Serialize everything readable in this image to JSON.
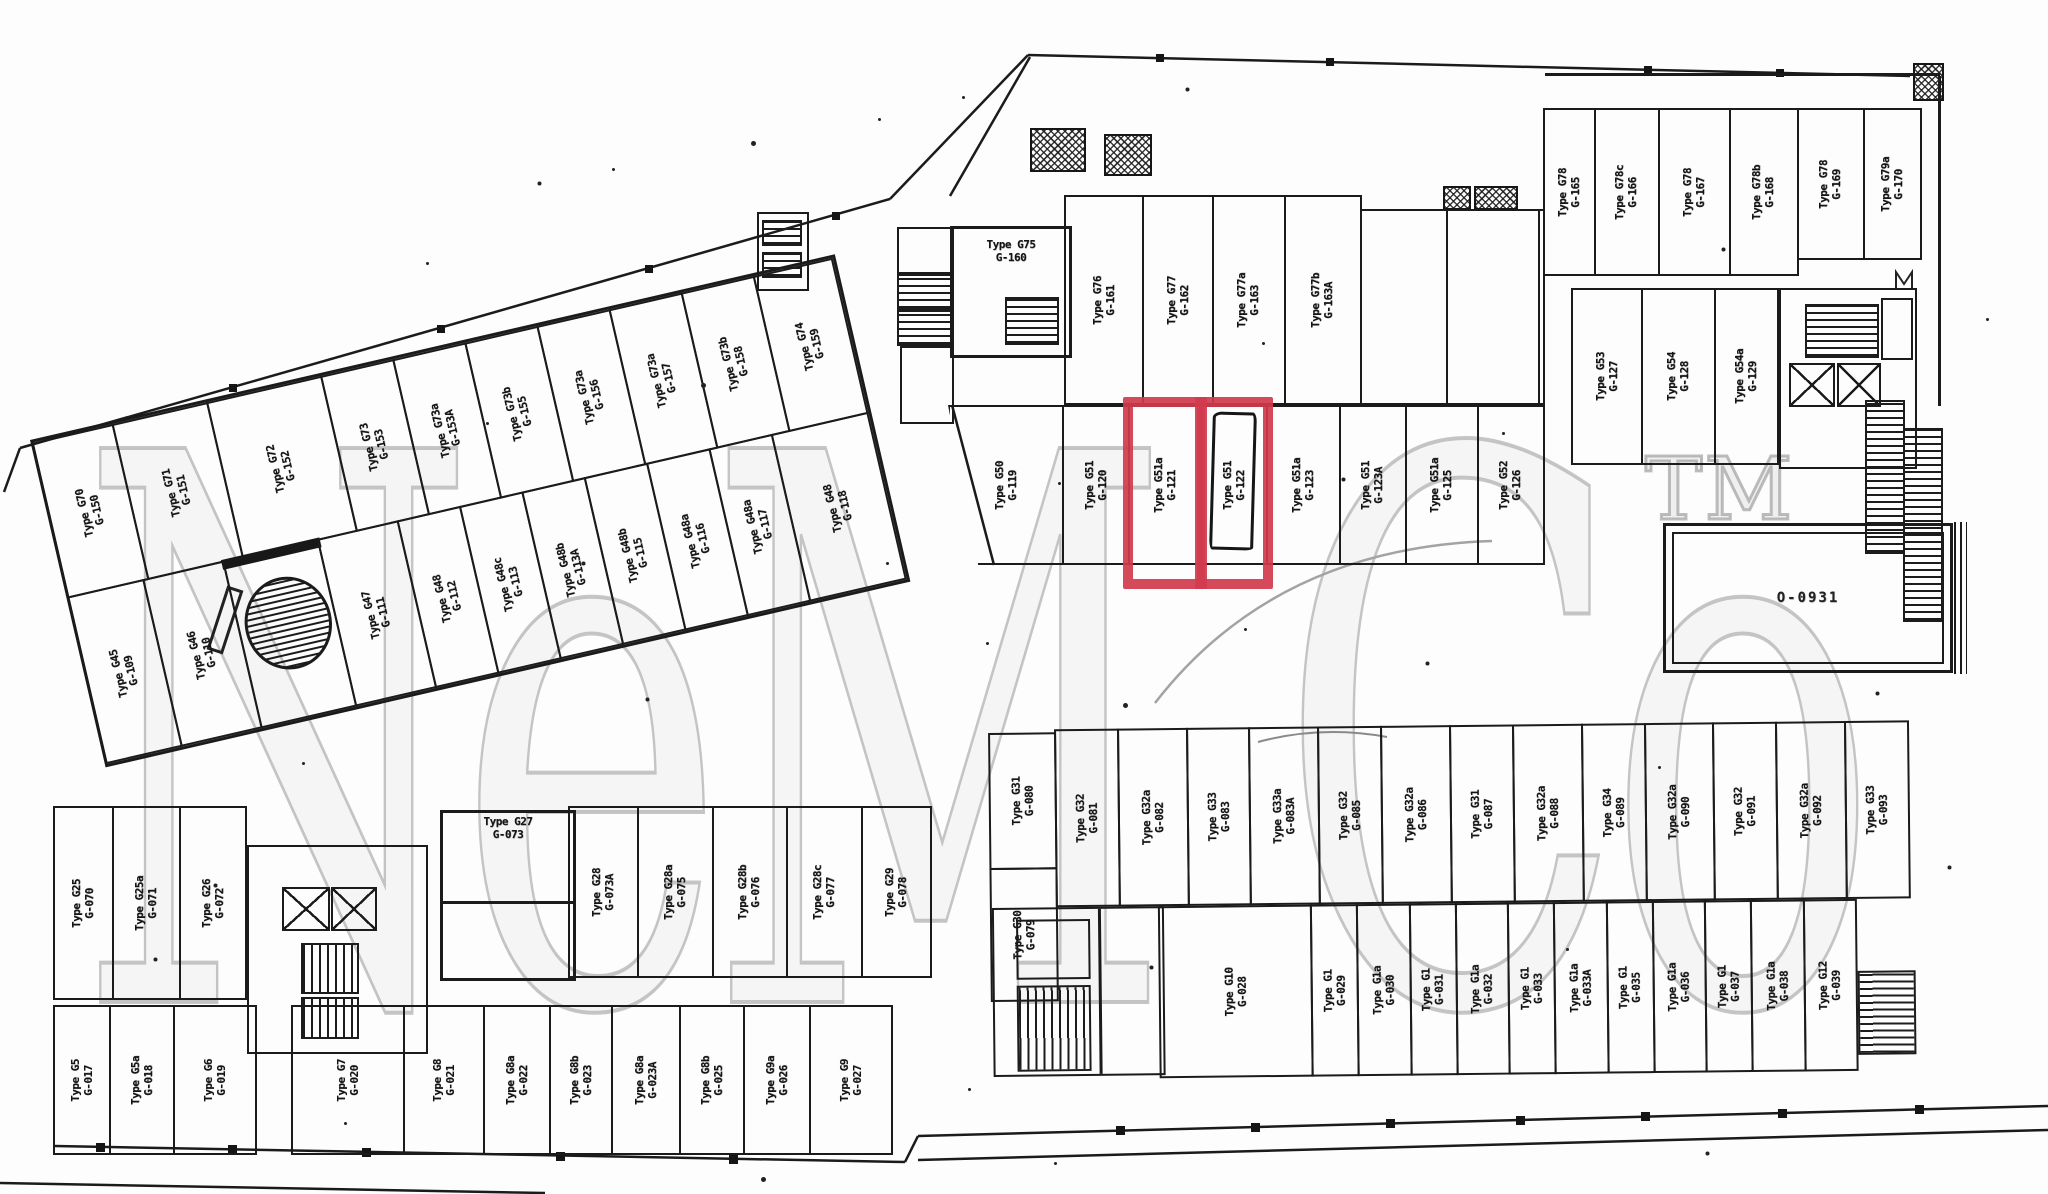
{
  "watermark": {
    "text": "NeM Co",
    "tm": "TM"
  },
  "highlight_color": "#d13b4d",
  "ramp": {
    "label": "O-0931"
  },
  "blocks": {
    "diagonal": {
      "top_row": [
        {
          "type": "Type G70",
          "unit": "G-150"
        },
        {
          "type": "Type G71",
          "unit": "G-151"
        },
        {
          "type": "Type G72",
          "unit": "G-152"
        },
        {
          "type": "Type G73",
          "unit": "G-153"
        },
        {
          "type": "Type G73a",
          "unit": "G-153A"
        },
        {
          "type": "Type G73b",
          "unit": "G-155"
        },
        {
          "type": "Type G73a",
          "unit": "G-156"
        },
        {
          "type": "Type G73a",
          "unit": "G-157"
        },
        {
          "type": "Type G73b",
          "unit": "G-158"
        },
        {
          "type": "Type G74",
          "unit": "G-159"
        }
      ],
      "bottom_row": [
        {
          "type": "Type G45",
          "unit": "G-109"
        },
        {
          "type": "Type G46",
          "unit": "G-110"
        },
        {
          "kind": "oval-ramp"
        },
        {
          "type": "Type G47",
          "unit": "G-111"
        },
        {
          "type": "Type G48",
          "unit": "G-112"
        },
        {
          "type": "Type G48c",
          "unit": "G-113"
        },
        {
          "type": "Type G48b",
          "unit": "G-113A"
        },
        {
          "type": "Type G48b",
          "unit": "G-115"
        },
        {
          "type": "Type G48a",
          "unit": "G-116"
        },
        {
          "type": "Type G48a",
          "unit": "G-117"
        },
        {
          "type": "Type G48",
          "unit": "G-118"
        }
      ]
    },
    "central": {
      "g160": {
        "type": "Type G75",
        "unit": "G-160"
      },
      "top_row": [
        {
          "type": "Type G76",
          "unit": "G-161"
        },
        {
          "type": "Type G77",
          "unit": "G-162"
        },
        {
          "type": "Type G77a",
          "unit": "G-163"
        },
        {
          "type": "Type G77b",
          "unit": "G-163A"
        },
        {
          "kind": "open"
        },
        {
          "kind": "open"
        },
        {
          "kind": "open"
        }
      ],
      "bottom_row": [
        {
          "type": "Type G50",
          "unit": "G-119"
        },
        {
          "type": "Type G51",
          "unit": "G-120"
        },
        {
          "type": "Type G51a",
          "unit": "G-121",
          "highlight": true
        },
        {
          "type": "Type G51",
          "unit": "G-122",
          "highlight": true,
          "scribble": true
        },
        {
          "type": "Type G51a",
          "unit": "G-123"
        },
        {
          "type": "Type G51",
          "unit": "G-123A"
        },
        {
          "type": "Type G51a",
          "unit": "G-125"
        },
        {
          "type": "Type G52",
          "unit": "G-126"
        }
      ]
    },
    "right": {
      "top_row": [
        {
          "type": "Type G78",
          "unit": "G-165"
        },
        {
          "type": "Type G78c",
          "unit": "G-166"
        },
        {
          "type": "Type G78",
          "unit": "G-167"
        },
        {
          "type": "Type G78b",
          "unit": "G-168"
        },
        {
          "type": "Type G78",
          "unit": "G-169"
        },
        {
          "type": "Type G79a",
          "unit": "G-170"
        }
      ],
      "mid_row": [
        {
          "type": "Type G53",
          "unit": "G-127"
        },
        {
          "type": "Type G54",
          "unit": "G-128"
        },
        {
          "type": "Type G54a",
          "unit": "G-129"
        }
      ]
    },
    "southwest": {
      "row1": [
        {
          "type": "Type G25",
          "unit": "G-070"
        },
        {
          "type": "Type G25a",
          "unit": "G-071"
        },
        {
          "type": "Type G26",
          "unit": "G-072"
        }
      ],
      "g073": {
        "type": "Type G27",
        "unit": "G-073"
      },
      "row1b": [
        {
          "type": "Type G28",
          "unit": "G-073A"
        },
        {
          "type": "Type G28a",
          "unit": "G-075"
        },
        {
          "type": "Type G28b",
          "unit": "G-076"
        },
        {
          "type": "Type G28c",
          "unit": "G-077"
        },
        {
          "type": "Type G29",
          "unit": "G-078"
        }
      ],
      "row2": [
        {
          "type": "Type G5",
          "unit": "G-017"
        },
        {
          "type": "Type G5a",
          "unit": "G-018"
        },
        {
          "type": "Type G6",
          "unit": "G-019"
        },
        {
          "kind": "gap"
        },
        {
          "type": "Type G7",
          "unit": "G-020"
        },
        {
          "type": "Type G8",
          "unit": "G-021"
        },
        {
          "type": "Type G8a",
          "unit": "G-022"
        },
        {
          "type": "Type G8b",
          "unit": "G-023"
        },
        {
          "type": "Type G8a",
          "unit": "G-023A"
        },
        {
          "type": "Type G8b",
          "unit": "G-025"
        },
        {
          "type": "Type G9a",
          "unit": "G-026"
        },
        {
          "type": "Type G9",
          "unit": "G-027"
        }
      ]
    },
    "southeast": {
      "left_col": [
        {
          "type": "Type G31",
          "unit": "G-080"
        },
        {
          "type": "Type G30",
          "unit": "G-079"
        }
      ],
      "top_row": [
        {
          "type": "Type G32",
          "unit": "G-081"
        },
        {
          "type": "Type G32a",
          "unit": "G-082"
        },
        {
          "type": "Type G33",
          "unit": "G-083"
        },
        {
          "type": "Type G33a",
          "unit": "G-083A"
        },
        {
          "type": "Type G32",
          "unit": "G-085"
        },
        {
          "type": "Type G32a",
          "unit": "G-086"
        },
        {
          "type": "Type G31",
          "unit": "G-087"
        },
        {
          "type": "Type G32a",
          "unit": "G-088"
        },
        {
          "type": "Type G34",
          "unit": "G-089"
        },
        {
          "type": "Type G32a",
          "unit": "G-090"
        },
        {
          "type": "Type G32",
          "unit": "G-091"
        },
        {
          "type": "Type G32a",
          "unit": "G-092"
        },
        {
          "type": "Type G33",
          "unit": "G-093"
        }
      ],
      "bottom_row": [
        {
          "type": "Type G10",
          "unit": "G-028"
        },
        {
          "type": "Type G1",
          "unit": "G-029"
        },
        {
          "type": "Type G1a",
          "unit": "G-030"
        },
        {
          "type": "Type G1",
          "unit": "G-031"
        },
        {
          "type": "Type G1a",
          "unit": "G-032"
        },
        {
          "type": "Type G1",
          "unit": "G-033"
        },
        {
          "type": "Type G1a",
          "unit": "G-033A"
        },
        {
          "type": "Type G1",
          "unit": "G-035"
        },
        {
          "type": "Type G1a",
          "unit": "G-036"
        },
        {
          "type": "Type G1",
          "unit": "G-037"
        },
        {
          "type": "Type G1a",
          "unit": "G-038"
        },
        {
          "type": "Type G12",
          "unit": "G-039"
        }
      ]
    }
  }
}
